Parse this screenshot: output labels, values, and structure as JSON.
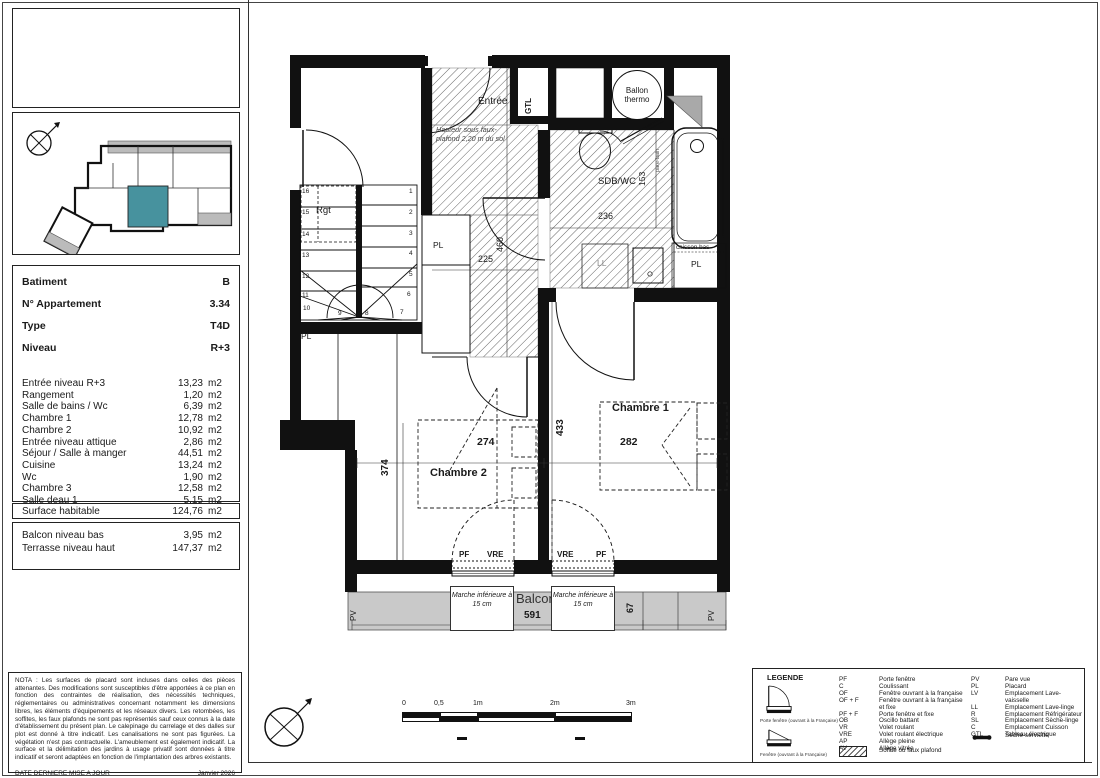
{
  "info_panel": {
    "fields": [
      {
        "label": "Batiment",
        "value": "B"
      },
      {
        "label": "N° Appartement",
        "value": "3.34"
      },
      {
        "label": "Type",
        "value": "T4D"
      },
      {
        "label": "Niveau",
        "value": "R+3"
      }
    ],
    "rooms": [
      {
        "name": "Entrée niveau R+3",
        "area": "13,23",
        "unit": "m2"
      },
      {
        "name": "Rangement",
        "area": "1,20",
        "unit": "m2"
      },
      {
        "name": "Salle de bains / Wc",
        "area": "6,39",
        "unit": "m2"
      },
      {
        "name": "Chambre 1",
        "area": "12,78",
        "unit": "m2"
      },
      {
        "name": "Chambre 2",
        "area": "10,92",
        "unit": "m2"
      },
      {
        "name": "Entrée niveau attique",
        "area": "2,86",
        "unit": "m2"
      },
      {
        "name": "Séjour / Salle à manger",
        "area": "44,51",
        "unit": "m2"
      },
      {
        "name": "Cuisine",
        "area": "13,24",
        "unit": "m2"
      },
      {
        "name": "Wc",
        "area": "1,90",
        "unit": "m2"
      },
      {
        "name": "Chambre 3",
        "area": "12,58",
        "unit": "m2"
      },
      {
        "name": "Salle deau 1",
        "area": "5,15",
        "unit": "m2"
      }
    ],
    "surface": {
      "label": "Surface habitable",
      "area": "124,76",
      "unit": "m2"
    },
    "exterior": [
      {
        "name": "Balcon niveau bas",
        "area": "3,95",
        "unit": "m2"
      },
      {
        "name": "Terrasse niveau haut",
        "area": "147,37",
        "unit": "m2"
      }
    ]
  },
  "nota": {
    "text": "NOTA : Les surfaces de placard sont incluses dans celles des pièces attenantes. Des modifications sont susceptibles d'être apportées à ce plan en fonction des contraintes de réalisation, des nécessités techniques, réglementaires ou administratives concernant notamment les dimensions libres, les éléments d'équipements et les réseaux divers. Les retombées, les soffites, les faux plafonds ne sont pas représentés sauf ceux connus à la date d'établissement du présent plan. Le calepinage du carrelage et des dalles sur plot est donné à titre indicatif. Les canalisations ne sont pas figurées. La végétation n'est pas contractuelle. L'ameublement est également indicatif. La surface et la délimitation des jardins à usage privatif sont données à titre indicatif et seront adaptées en fonction de l'implantation des arbres existants.",
    "date_label": "DATE DERNIERE MISE A JOUR",
    "date_value": "Janvier 2026"
  },
  "legend": {
    "title": "LEGENDE",
    "door_icon_caption": "Porte fenêtre (ouvrant à la Française)",
    "window_icon_caption": "Fenêtre (ouvrant à la Française)",
    "col1": [
      {
        "code": "PF",
        "desc": "Porte fenêtre"
      },
      {
        "code": "C",
        "desc": "Coulissant"
      },
      {
        "code": "OF",
        "desc": "Fenêtre ouvrant à la française"
      },
      {
        "code": "OF + F",
        "desc": "Fenêtre ouvrant à la française et fixe"
      },
      {
        "code": "PF + F",
        "desc": "Porte fenêtre et fixe"
      },
      {
        "code": "OB",
        "desc": "Oscillo battant"
      },
      {
        "code": "VR",
        "desc": "Volet roulant"
      },
      {
        "code": "VRE",
        "desc": "Volet roulant électrique"
      },
      {
        "code": "AP",
        "desc": "Allège pleine"
      },
      {
        "code": "AV",
        "desc": "Allège vitrée"
      }
    ],
    "soffite_label": "Soffite ou faux plafond",
    "col2": [
      {
        "code": "PV",
        "desc": "Pare vue"
      },
      {
        "code": "PL",
        "desc": "Placard"
      },
      {
        "code": "LV",
        "desc": "Emplacement Lave-vaisselle"
      },
      {
        "code": "LL",
        "desc": "Emplacement Lave-linge"
      },
      {
        "code": "R",
        "desc": "Emplacement Réfrigérateur"
      },
      {
        "code": "SL",
        "desc": "Emplacement Sèche-linge"
      },
      {
        "code": "C",
        "desc": "Emplacement Cuisson"
      },
      {
        "code": "GTL",
        "desc": "Tableau électrique"
      }
    ],
    "radiator_label": "Sèche-serviette"
  },
  "plan": {
    "labels": {
      "entree": "Entrée",
      "gtl": "GTL",
      "ballon": "Ballon thermo",
      "sdb": "SDB/WC",
      "chambre1": "Chambre 1",
      "chambre2": "Chambre 2",
      "balcon": "Balcon",
      "rgt": "Rgt",
      "pl": "PL",
      "ll": "LL",
      "caisson": "caisson bas",
      "pare_bain": "pare-bain",
      "pv": "PV"
    },
    "ceiling_note": "Hauteur sous faux-plafond 2,20 m du sol",
    "step_note": "Marche inférieure à 15 cm",
    "window_labels": {
      "left_a": "PF",
      "left_b": "VRE",
      "right_a": "VRE",
      "right_b": "PF"
    },
    "dims": {
      "entree_w": "225",
      "entree_h": "460",
      "sdb_w": "236",
      "sdb_h": "153",
      "ch2_w": "274",
      "ch1_w": "282",
      "ch2_h": "374",
      "corridor_h": "433",
      "balcon_w": "591",
      "balcon_e": "67"
    },
    "stairs": [
      "1",
      "2",
      "3",
      "4",
      "5",
      "6",
      "7",
      "8",
      "9",
      "10",
      "11",
      "12",
      "13",
      "14",
      "15",
      "16"
    ]
  },
  "scale_bar": {
    "ticks": [
      "0",
      "0,5",
      "1m",
      "2m",
      "3m"
    ]
  },
  "colors": {
    "highlight_teal": "#47929e",
    "balcony_gray": "#c9c9c9"
  }
}
